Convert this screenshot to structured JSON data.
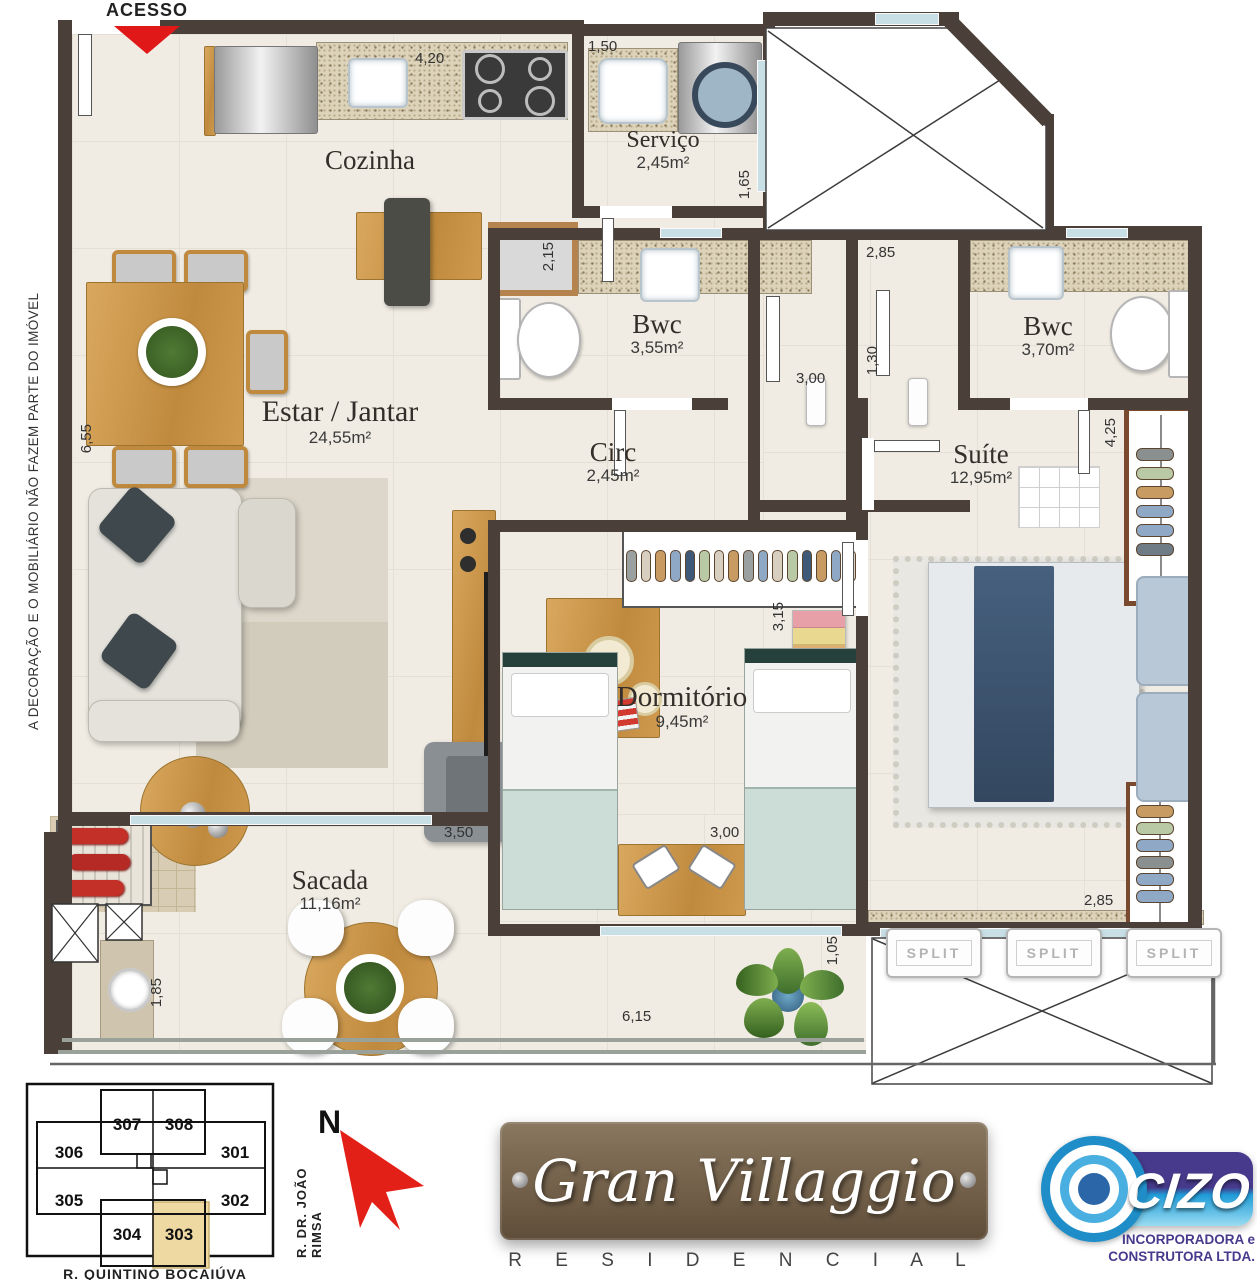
{
  "plan": {
    "access_label": "ACESSO",
    "disclaimer": "A DECORAÇÃO E O MOBILIÁRIO NÃO FAZEM PARTE DO IMÓVEL",
    "rooms": [
      {
        "name": "Cozinha",
        "area": ""
      },
      {
        "name": "Serviço",
        "area": "2,45m²"
      },
      {
        "name": "Bwc",
        "area": "3,55m²"
      },
      {
        "name": "Bwc",
        "area": "3,70m²"
      },
      {
        "name": "Estar / Jantar",
        "area": "24,55m²"
      },
      {
        "name": "Circ",
        "area": "2,45m²"
      },
      {
        "name": "Suíte",
        "area": "12,95m²"
      },
      {
        "name": "Dormitório",
        "area": "9,45m²"
      },
      {
        "name": "Sacada",
        "area": "11,16m²"
      }
    ],
    "dimensions": [
      "4,20",
      "1,50",
      "1,65",
      "2,15",
      "2,85",
      "3,00",
      "1,30",
      "4,25",
      "6,55",
      "3,15",
      "3,50",
      "3,00",
      "2,85",
      "1,05",
      "1,85",
      "6,15"
    ],
    "split_label": "SPLIT"
  },
  "keyplan": {
    "units": [
      "306",
      "307",
      "308",
      "301",
      "305",
      "304",
      "303",
      "302"
    ],
    "highlighted_unit": "303",
    "street_right": "R.  DR.  JOÃO  RIMSA",
    "street_bottom": "R.  QUINTINO  BOCAIÚVA",
    "north_label": "N"
  },
  "branding": {
    "project_name": "Gran Villaggio",
    "project_type": "R E S I D E N C I A L",
    "builder_name": "CIZO",
    "builder_line1": "INCORPORADORA e",
    "builder_line2": "CONSTRUTORA LTDA."
  },
  "colors": {
    "wall": "#4a3f39",
    "floor": "#f0ece3",
    "wood": "#c9944a",
    "accent_red": "#e01818",
    "cizo_purple": "#473a8c",
    "cizo_blue": "#1f9cd8",
    "unit_highlight": "#eed9a2"
  }
}
